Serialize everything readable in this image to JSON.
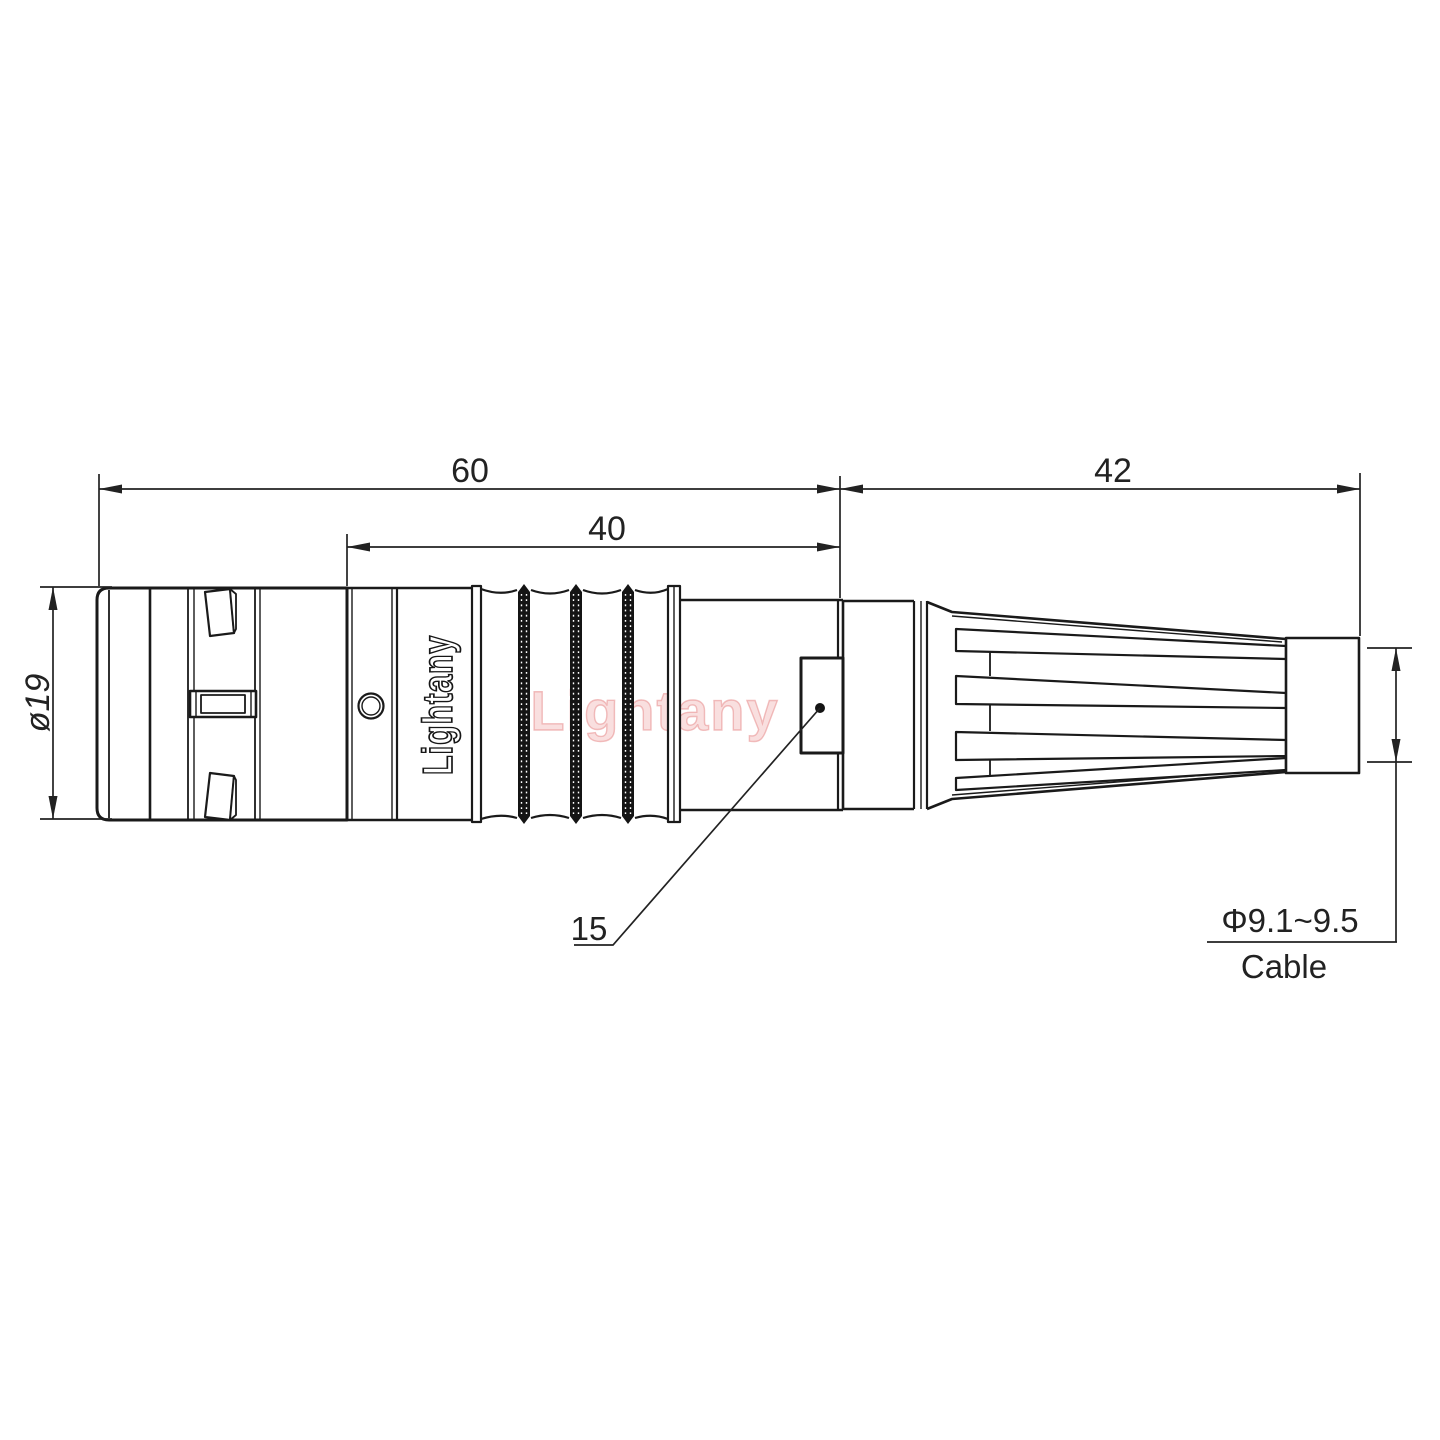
{
  "page": {
    "background": "#ffffff"
  },
  "drawing": {
    "title": "connector outline drawing",
    "dimensions": {
      "overall_length": "60",
      "front_section_length": "40",
      "boot_length": "42",
      "shell_diameter": "ø19",
      "rear_body_diameter": "15",
      "cable_diameter": "Φ9.1~9.5",
      "cable_label": "Cable"
    },
    "branding": {
      "logo_text": "Lightany",
      "watermark_text": "Lightany"
    },
    "colors": {
      "line_color": "#1a1a1a",
      "dimension_color": "#222222",
      "watermark_color": "#eeaaaa",
      "background": "#ffffff"
    }
  }
}
